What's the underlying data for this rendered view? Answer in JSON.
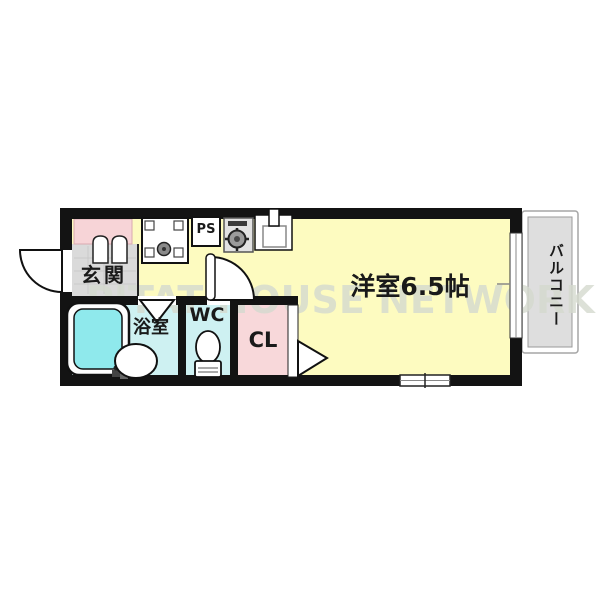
{
  "floorplan": {
    "watermark": "PITAT HOUSE NETWORK",
    "rooms": {
      "entrance": {
        "label": "玄関"
      },
      "bathroom": {
        "label": "浴室"
      },
      "toilet": {
        "label": "WC"
      },
      "closet": {
        "label": "CL"
      },
      "main_room": {
        "label": "洋室6.5帖",
        "size": "6.5帖"
      },
      "balcony": {
        "label": "バルコニー"
      },
      "pipe_space": {
        "label": "PS"
      }
    },
    "fixtures": [
      "washing-machine-pan-icon",
      "gas-stove-icon",
      "kitchen-sink-icon",
      "bathtub-icon",
      "wash-basin-icon",
      "toilet-icon",
      "entrance-door-swing-icon",
      "room-door-swing-icon",
      "folding-bath-door-icon",
      "closet-door-triangle-icon",
      "double-door-icon",
      "window-icon"
    ],
    "colors": {
      "room_yellow": "#FDFBC0",
      "closet_pink": "#F8D8DA",
      "alcove_pink": "#F7D4D7",
      "wet_cyan": "#CEF1F2",
      "tub_cyan": "#8FE9EC",
      "entrance_gray": "#DADADA",
      "balcony_gray": "#DEDEDE",
      "wall_black": "#131313",
      "watermark_gray": "#D5DACF"
    }
  }
}
